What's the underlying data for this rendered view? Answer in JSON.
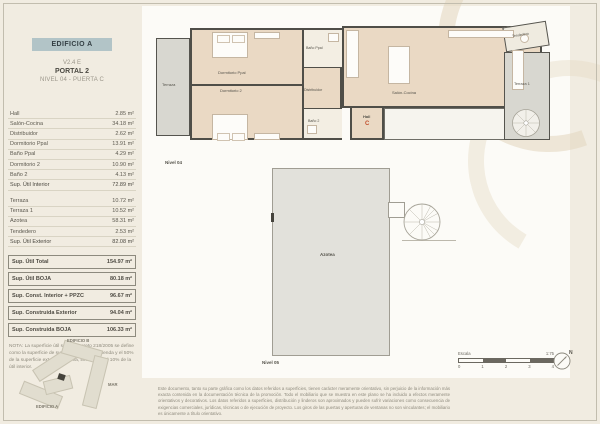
{
  "header": {
    "badge": "EDIFICIO A",
    "version": "V2.4 E",
    "portal": "PORTAL 2",
    "level": "NIVEL 04 - PUERTA C"
  },
  "areas": {
    "interior": [
      {
        "label": "Hall",
        "value": "2.85 m²"
      },
      {
        "label": "Salón-Cocina",
        "value": "34.18 m²"
      },
      {
        "label": "Distribuidor",
        "value": "2.62 m²"
      },
      {
        "label": "Dormitorio Ppal",
        "value": "13.91 m²"
      },
      {
        "label": "Baño Ppal",
        "value": "4.29 m²"
      },
      {
        "label": "Dormitorio 2",
        "value": "10.90 m²"
      },
      {
        "label": "Baño 2",
        "value": "4.13 m²"
      }
    ],
    "interior_total": {
      "label": "Sup. Útil Interior",
      "value": "72.89 m²"
    },
    "exterior": [
      {
        "label": "Terraza",
        "value": "10.72 m²"
      },
      {
        "label": "Terraza 1",
        "value": "10.52 m²"
      },
      {
        "label": "Azotea",
        "value": "58.31 m²"
      },
      {
        "label": "Tendedero",
        "value": "2.53 m²"
      }
    ],
    "exterior_total": {
      "label": "Sup. Útil Exterior",
      "value": "82.08 m²"
    },
    "summary": [
      {
        "label": "Sup. Útil Total",
        "value": "154.97 m²"
      },
      {
        "label": "Sup. Útil BOJA",
        "value": "80.18 m²"
      },
      {
        "label": "Sup. Const. Interior + PPZC",
        "value": "96.67 m²"
      },
      {
        "label": "Sup. Construida Exterior",
        "value": "94.04 m²"
      },
      {
        "label": "Sup. Construida BOJA",
        "value": "106.33 m²"
      }
    ]
  },
  "note": "NOTA: La superficie útil según Decreto 218/2005 se define como la superficie de suelo interior de la vivienda y el 50% de la superficie exterior privativa, limitándola al 10% de la útil interior.",
  "site_plan": {
    "edificio_b": "EDIFICIO B",
    "edificio_a": "EDIFICIO A",
    "mar": "MAR"
  },
  "plan": {
    "nivel04": "Nivel 04",
    "nivel05": "Nivel 05",
    "terraza": "Terraza",
    "dormitorio_ppal": "Dormitorio Ppal",
    "dormitorio_2": "Dormitorio 2",
    "bano_ppal": "Baño Ppal",
    "distribuidor": "Distribuidor",
    "bano_2": "Baño 2",
    "salon_cocina": "Salón-Cocina",
    "hall": "Hall",
    "door_letter": "C",
    "tendedero": "Tendedero",
    "terraza_1": "Terraza 1",
    "azotea": "Azotea"
  },
  "scale": {
    "label": "Escala",
    "ratio": "1:75",
    "ticks": [
      "0",
      "1",
      "2",
      "3",
      "4"
    ],
    "north": "N"
  },
  "disclaimer": "Este documento, tanto su parte gráfica como los datos referidos a superficies, tienen carácter meramente orientativo, sin perjuicio de la información más exacta contenida en la documentación técnica de la promoción. Todo el mobiliario que se muestra en este plano se ha incluido a efectos meramente orientativos y decorativos. Los datos referidos a superficies, distribución y linderos son aproximados y pueden sufrir variaciones como consecuencia de exigencias comerciales, jurídicas, técnicas o de ejecución de proyecto. Los giros de las puertas y aperturas de ventanas no son vinculantes; el mobiliario es únicamente a título orientativo.",
  "colors": {
    "badge_bg": "#b2c4c7",
    "room_fill": "#ead9c4",
    "terrace_fill": "#d8d7d0",
    "wall": "#4f4e48",
    "door_letter": "#c2502e",
    "paper": "#f1ece1"
  }
}
